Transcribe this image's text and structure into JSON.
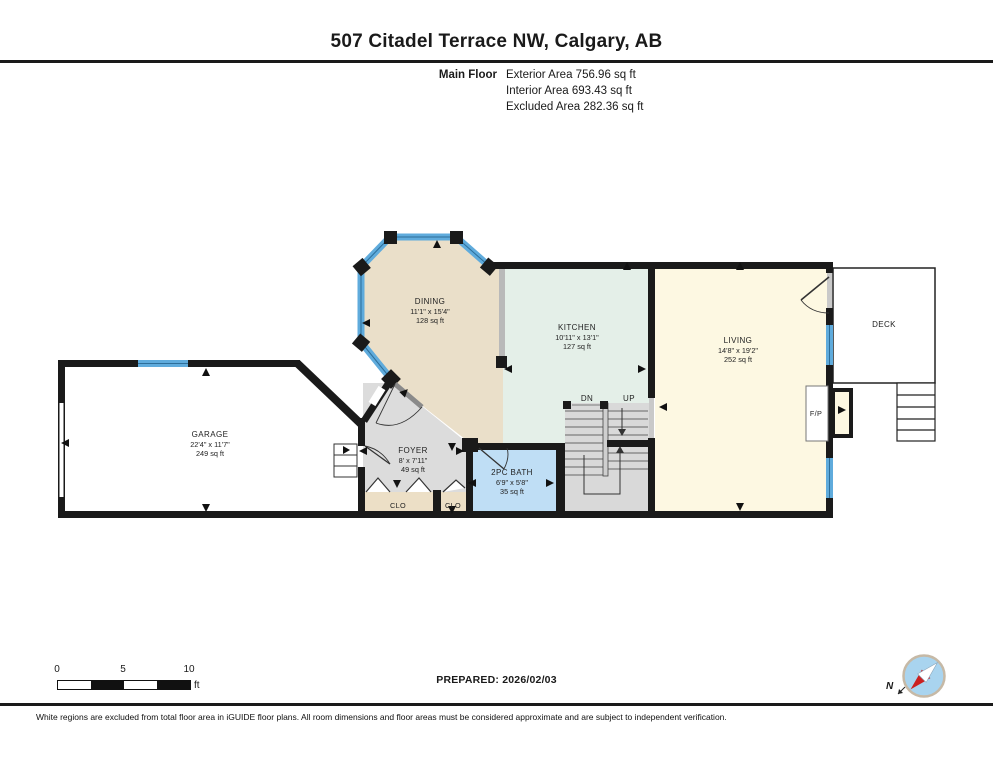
{
  "header": {
    "title": "507 Citadel Terrace NW, Calgary, AB",
    "floor_label": "Main Floor",
    "stats": {
      "exterior": "Exterior Area 756.96 sq ft",
      "interior": "Interior Area 693.43 sq ft",
      "excluded": "Excluded Area 282.36 sq ft"
    }
  },
  "plan": {
    "rooms": {
      "dining": {
        "name": "DINING",
        "dims": "11'1\" x 15'4\"",
        "area": "128 sq ft"
      },
      "kitchen": {
        "name": "KITCHEN",
        "dims": "10'11\" x 13'1\"",
        "area": "127 sq ft"
      },
      "living": {
        "name": "LIVING",
        "dims": "14'8\" x 19'2\"",
        "area": "252 sq ft"
      },
      "garage": {
        "name": "GARAGE",
        "dims": "22'4\" x 11'7\"",
        "area": "249 sq ft"
      },
      "foyer": {
        "name": "FOYER",
        "dims": "8' x 7'11\"",
        "area": "49 sq ft"
      },
      "bath": {
        "name": "2PC BATH",
        "dims": "6'9\" x 5'8\"",
        "area": "35 sq ft"
      },
      "deck": {
        "name": "DECK"
      },
      "closet_left": {
        "name": "CLO"
      },
      "closet_right": {
        "name": "CLO"
      }
    },
    "labels": {
      "down": "DN",
      "up": "UP",
      "fireplace": "F/P"
    }
  },
  "footer": {
    "scale": {
      "t0": "0",
      "t5": "5",
      "t10": "10",
      "unit": "ft"
    },
    "prepared": "PREPARED: 2026/02/03",
    "compass_north": "N",
    "disclaimer": "White regions are excluded from total floor area in iGUIDE floor plans. All room dimensions and floor areas must be considered approximate and are subject to independent verification."
  },
  "colors": {
    "wall": "#1a1a1a",
    "window": "#5fabdc",
    "dining_floor": "#eadfc9",
    "kitchen_floor": "#e4efe8",
    "living_floor": "#fdf8e2",
    "foyer_floor": "#dcdcdc",
    "bath_floor": "#bfdef5",
    "closet_floor": "#ecdfc6",
    "stairs_floor": "#d9d9d9",
    "excluded_floor": "#ffffff"
  }
}
